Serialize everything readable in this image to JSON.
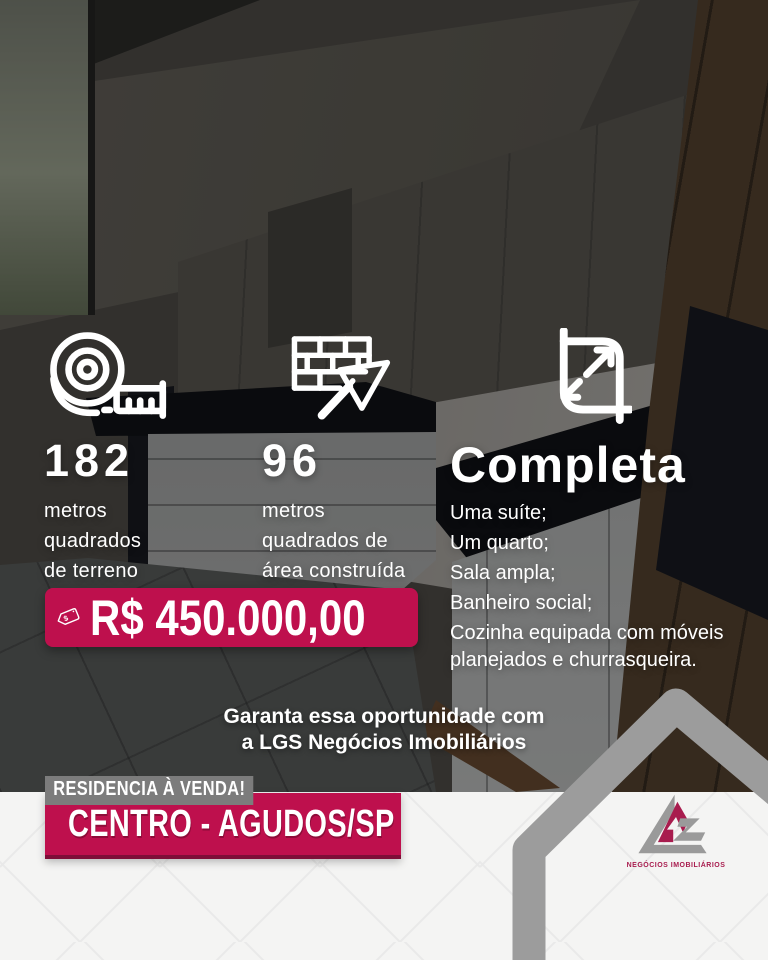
{
  "colors": {
    "accent": "#BE104D",
    "accent_dark": "#7E0E38",
    "badge_gray": "#7C7C7C",
    "footer_bg": "#F4F4F3",
    "pattern_line": "#E9E9E9",
    "house_gray": "#9C9C9C",
    "logo_gray": "#9A9A9A",
    "logo_red": "#A81C4E",
    "text_white": "#FFFFFF"
  },
  "features": [
    {
      "icon": "measuring-tape-icon",
      "value": "182",
      "lines": [
        "metros",
        "quadrados",
        "de terreno"
      ]
    },
    {
      "icon": "bricks-trowel-icon",
      "value": "96",
      "lines": [
        "metros",
        "quadrados de",
        "área construída"
      ]
    }
  ],
  "details": {
    "icon": "expand-arrows-icon",
    "title": "Completa",
    "items": [
      "Uma suíte;",
      "Um quarto;",
      "Sala ampla;",
      "Banheiro social;",
      "Cozinha equipada com móveis planejados e churrasqueira."
    ]
  },
  "price": {
    "icon": "price-tag-icon",
    "currency_symbol": "$",
    "value": "R$ 450.000,00"
  },
  "cta": {
    "line1": "Garanta essa oportunidade com",
    "line2": "a LGS Negócios Imobiliários"
  },
  "footer": {
    "badge": "RESIDENCIA À VENDA!",
    "location": "CENTRO - AGUDOS/SP"
  },
  "logo": {
    "subtitle": "NEGÓCIOS IMOBILIÁRIOS"
  }
}
